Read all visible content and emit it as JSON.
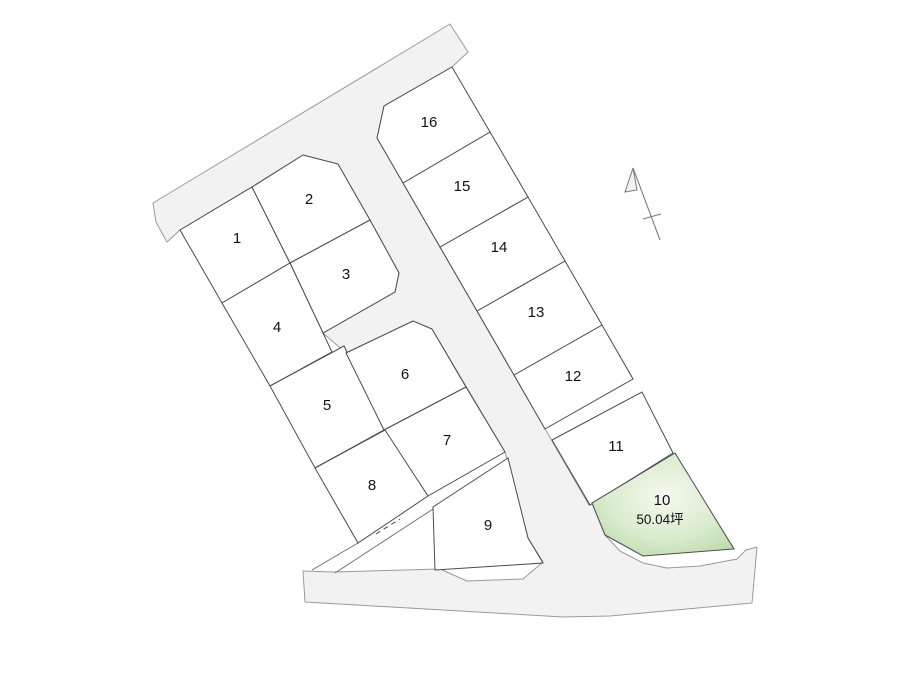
{
  "map": {
    "lots": [
      {
        "label": "1"
      },
      {
        "label": "2"
      },
      {
        "label": "3"
      },
      {
        "label": "4"
      },
      {
        "label": "5"
      },
      {
        "label": "6"
      },
      {
        "label": "7"
      },
      {
        "label": "8"
      },
      {
        "label": "9"
      },
      {
        "label": "10"
      },
      {
        "label": "11"
      },
      {
        "label": "12"
      },
      {
        "label": "13"
      },
      {
        "label": "14"
      },
      {
        "label": "15"
      },
      {
        "label": "16"
      }
    ],
    "highlight": {
      "label": "10",
      "area": "50.04坪"
    },
    "colors": {
      "road_fill": "#f2f2f2",
      "road_stroke": "#9a9a9a",
      "lot_fill": "#ffffff",
      "lot_stroke": "#4a4a4a",
      "highlight_center": "#f4f9f0",
      "highlight_mid": "#d9ebcd",
      "highlight_edge": "#b4d5a4",
      "label_color": "#111111"
    }
  }
}
